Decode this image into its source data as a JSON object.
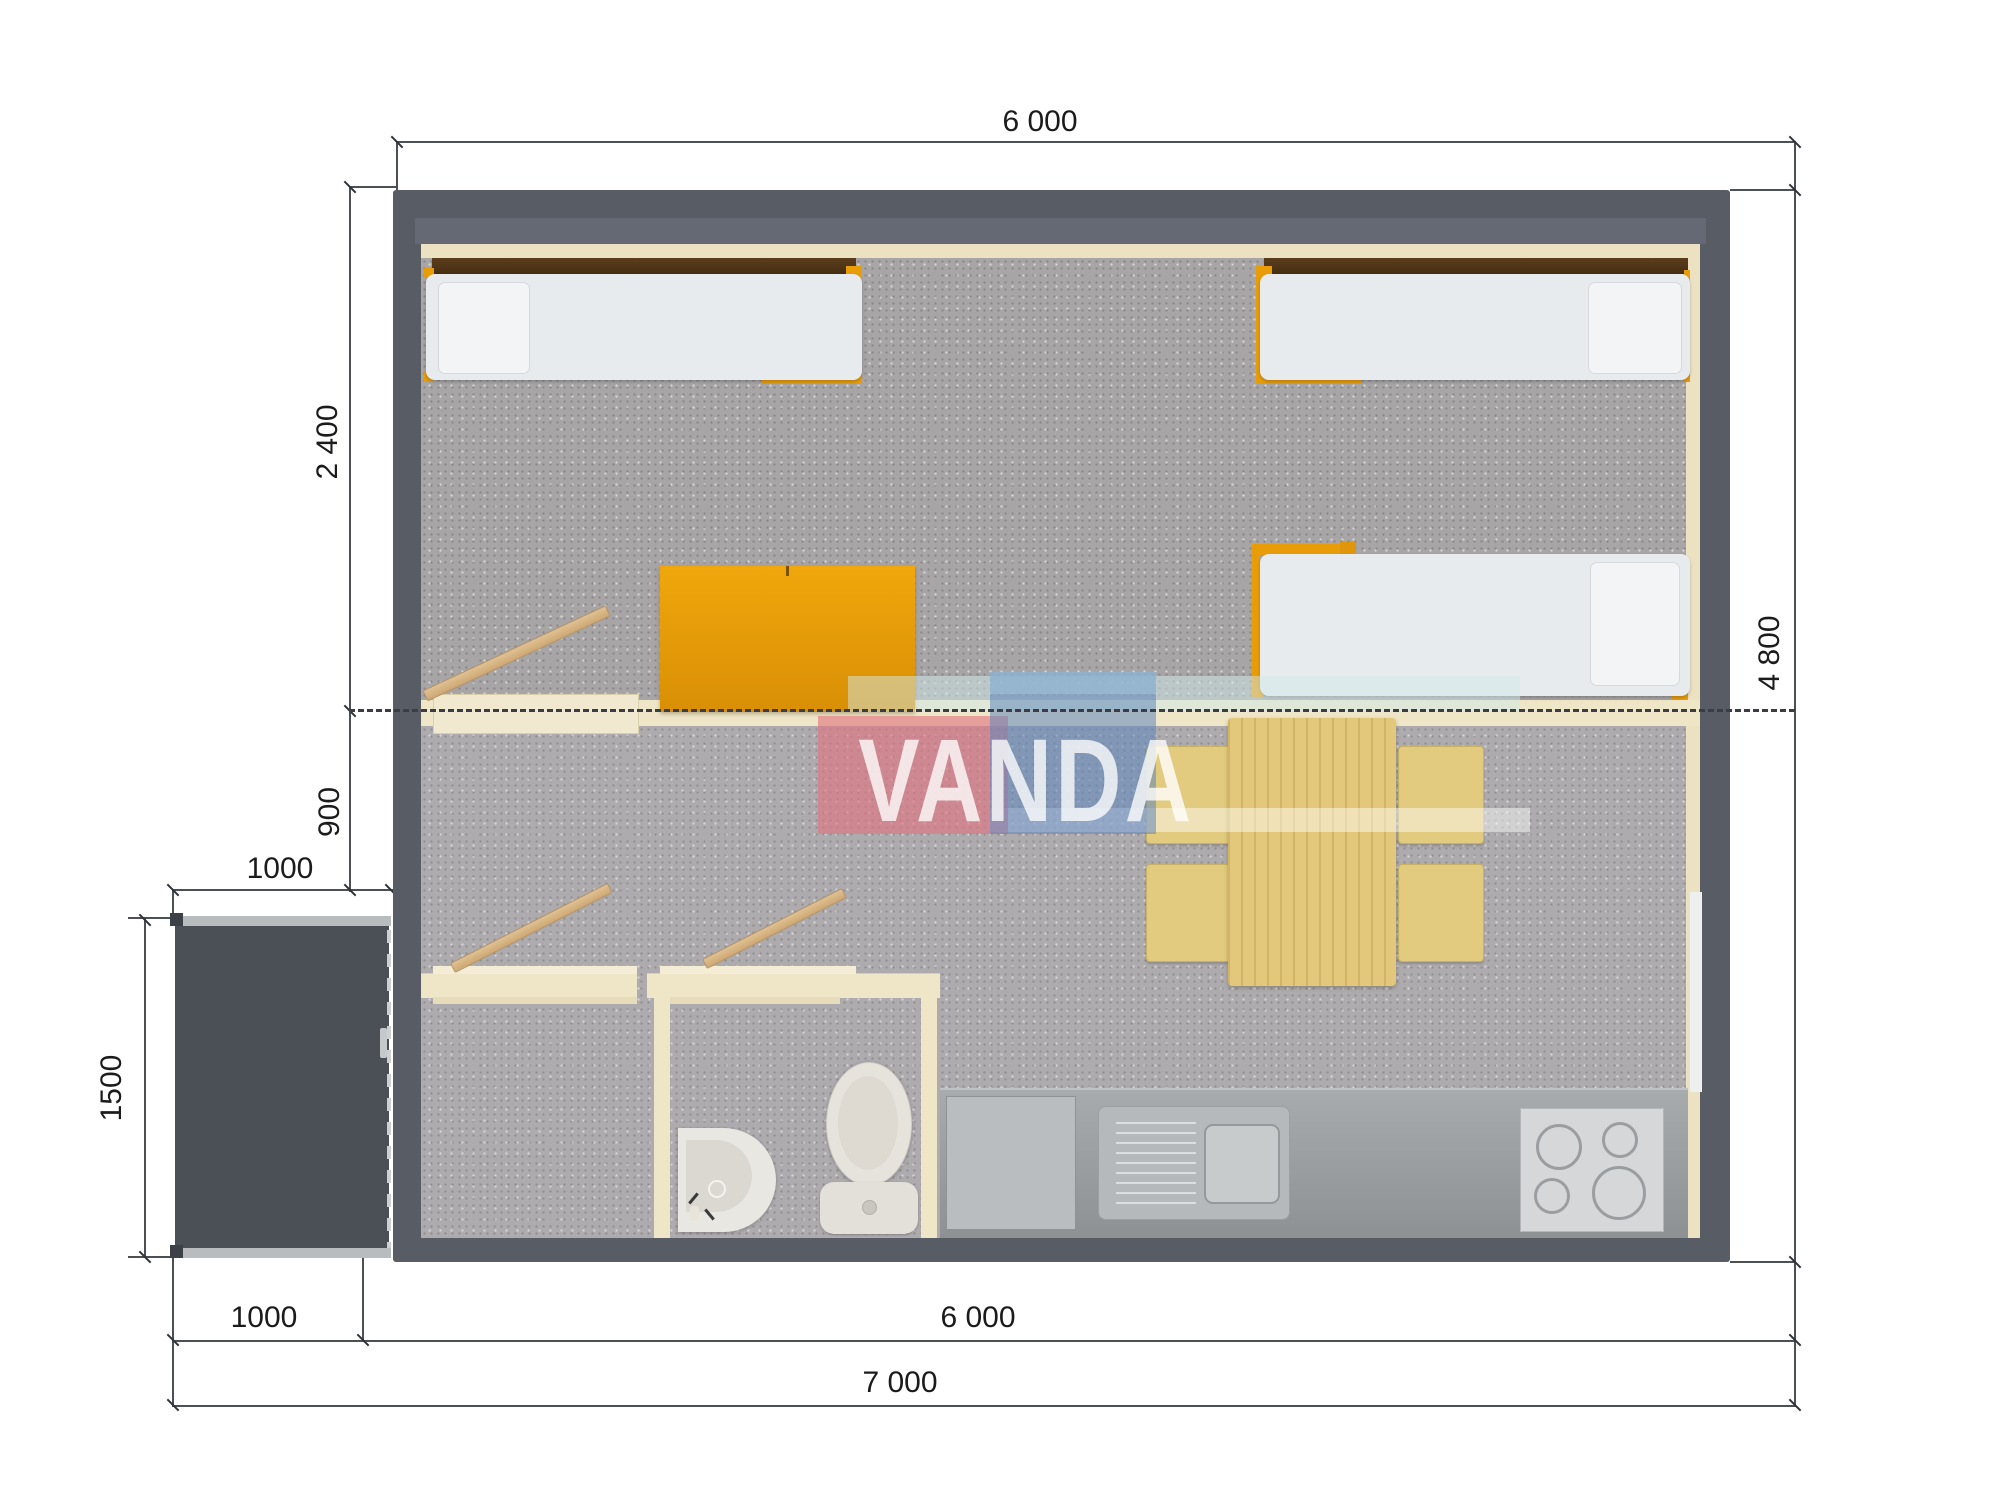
{
  "watermark": {
    "text": "VANDA",
    "pink": "#e2737f",
    "blue": "#5f87bb",
    "band": "#cfe9ea"
  },
  "dimensions": {
    "top_width": "6 000",
    "right_height": "4 800",
    "bedroom_depth": "2 400",
    "hall_depth": "900",
    "porch_width": "1000",
    "porch_depth": "1500",
    "bottom_porch_width": "1000",
    "bottom_house_width": "6 000",
    "bottom_total_width": "7 000"
  },
  "colors": {
    "wall": "#575c65",
    "porch": "#4b5057",
    "interior_lining": "#efe6c7",
    "carpet": "#a8a5a7",
    "bed_frame_orange": "#e89c08",
    "wood": "#d9b98c",
    "counter": "#9fa2a5"
  },
  "furniture": {
    "beds": 3,
    "wardrobe": "wardrobe",
    "dining_table": "dining-table",
    "chairs": 4,
    "stove_burners": 4,
    "kitchen_sink": "sink-with-drainboard",
    "bathroom": [
      "corner-washbasin",
      "toilet"
    ]
  }
}
